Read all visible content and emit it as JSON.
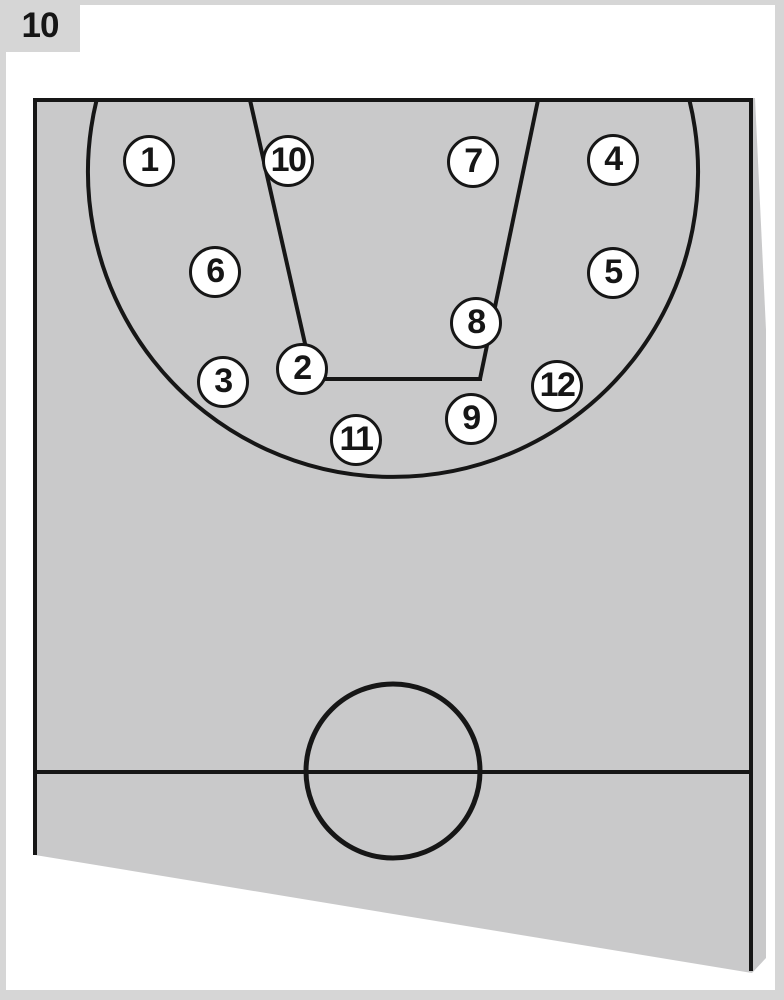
{
  "figure": {
    "number": "10"
  },
  "colors": {
    "outer_background": "#d6d6d6",
    "page_background": "#ffffff",
    "court_fill": "#c9c9ca",
    "line": "#161616",
    "marker_fill": "#ffffff",
    "marker_text": "#161616"
  },
  "court": {
    "type": "basketball-half-court-diagram",
    "markers": [
      {
        "label": "1",
        "x": 149,
        "y": 161
      },
      {
        "label": "10",
        "x": 288,
        "y": 161
      },
      {
        "label": "7",
        "x": 473,
        "y": 162
      },
      {
        "label": "4",
        "x": 613,
        "y": 160
      },
      {
        "label": "6",
        "x": 215,
        "y": 272
      },
      {
        "label": "5",
        "x": 613,
        "y": 273
      },
      {
        "label": "8",
        "x": 476,
        "y": 323
      },
      {
        "label": "2",
        "x": 302,
        "y": 369
      },
      {
        "label": "3",
        "x": 223,
        "y": 382
      },
      {
        "label": "12",
        "x": 557,
        "y": 386
      },
      {
        "label": "9",
        "x": 471,
        "y": 419
      },
      {
        "label": "11",
        "x": 356,
        "y": 440
      }
    ]
  }
}
